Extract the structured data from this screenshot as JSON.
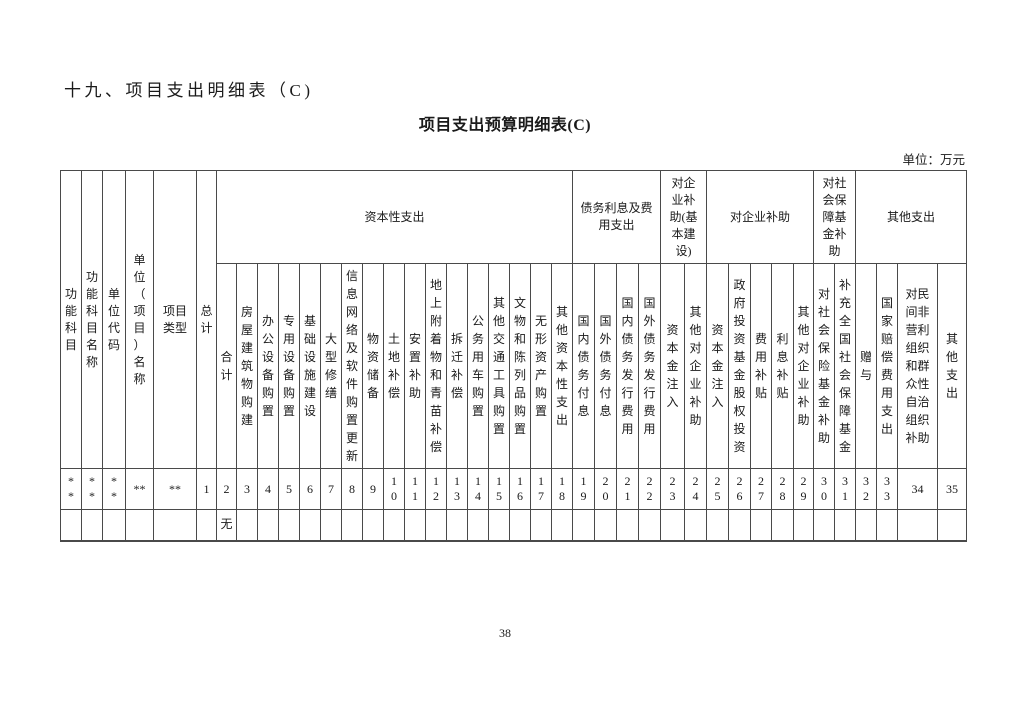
{
  "page": {
    "section_title": "十九、项目支出明细表（C)",
    "table_title": "项目支出预算明细表(C)",
    "unit_label": "单位：万元",
    "page_number": "38"
  },
  "colors": {
    "background": "#ffffff",
    "table_border": "#4a4a4a",
    "text": "#1a1a1a"
  },
  "table": {
    "fixed_columns": [
      {
        "label": "功\n能\n科\n目",
        "width": 21
      },
      {
        "label": "功\n能\n科\n目\n名\n称",
        "width": 21
      },
      {
        "label": "单\n位\n代\n码",
        "width": 23
      },
      {
        "label": "单\n位\n（\n项\n目\n）\n名\n称",
        "width": 28
      },
      {
        "label": "项目\n类型",
        "width": 43
      },
      {
        "label": "总\n计",
        "width": 20
      }
    ],
    "groups": [
      {
        "label": "资本性支出",
        "span": 17
      },
      {
        "label": "债务利息及费\n用支出",
        "span": 4
      },
      {
        "label": "对企\n业补\n助(基\n本建\n设)",
        "span": 2
      },
      {
        "label": "对企业补助",
        "span": 5
      },
      {
        "label": "对社\n会保\n障基\n金补\n助",
        "span": 2
      },
      {
        "label": "其他支出",
        "span": 4
      }
    ],
    "columns": [
      {
        "label": "合\n计",
        "width": 20
      },
      {
        "label": "房\n屋\n建\n筑\n物\n购\n建",
        "width": 21
      },
      {
        "label": "办\n公\n设\n备\n购\n置",
        "width": 21
      },
      {
        "label": "专\n用\n设\n备\n购\n置",
        "width": 21
      },
      {
        "label": "基\n础\n设\n施\n建\n设",
        "width": 21
      },
      {
        "label": "大\n型\n修\n缮",
        "width": 21
      },
      {
        "label": "信\n息\n网\n络\n及\n软\n件\n购\n置\n更\n新",
        "width": 21
      },
      {
        "label": "物\n资\n储\n备",
        "width": 21
      },
      {
        "label": "土\n地\n补\n偿",
        "width": 21
      },
      {
        "label": "安\n置\n补\n助",
        "width": 21
      },
      {
        "label": "地\n上\n附\n着\n物\n和\n青\n苗\n补\n偿",
        "width": 21
      },
      {
        "label": "拆\n迁\n补\n偿",
        "width": 21
      },
      {
        "label": "公\n务\n用\n车\n购\n置",
        "width": 21
      },
      {
        "label": "其\n他\n交\n通\n工\n具\n购\n置",
        "width": 21
      },
      {
        "label": "文\n物\n和\n陈\n列\n品\n购\n置",
        "width": 21
      },
      {
        "label": "无\n形\n资\n产\n购\n置",
        "width": 21
      },
      {
        "label": "其\n他\n资\n本\n性\n支\n出",
        "width": 21
      },
      {
        "label": "国\n内\n债\n务\n付\n息",
        "width": 22
      },
      {
        "label": "国\n外\n债\n务\n付\n息",
        "width": 22
      },
      {
        "label": "国\n内\n债\n务\n发\n行\n费\n用",
        "width": 22
      },
      {
        "label": "国\n外\n债\n务\n发\n行\n费\n用",
        "width": 22
      },
      {
        "label": "资\n本\n金\n注\n入",
        "width": 24
      },
      {
        "label": "其\n他\n对\n企\n业\n补\n助",
        "width": 22
      },
      {
        "label": "资\n本\n金\n注\n入",
        "width": 22
      },
      {
        "label": "政\n府\n投\n资\n基\n金\n股\n权\n投\n资",
        "width": 22
      },
      {
        "label": "费\n用\n补\n贴",
        "width": 21
      },
      {
        "label": "利\n息\n补\n贴",
        "width": 22
      },
      {
        "label": "其\n他\n对\n企\n业\n补\n助",
        "width": 20
      },
      {
        "label": "对\n社\n会\n保\n险\n基\n金\n补\n助",
        "width": 21
      },
      {
        "label": "补\n充\n全\n国\n社\n会\n保\n障\n基\n金",
        "width": 21
      },
      {
        "label": "赠\n与",
        "width": 21
      },
      {
        "label": "国\n家\n赔\n偿\n费\n用\n支\n出",
        "width": 21
      },
      {
        "label": "对民\n间非\n营利\n组织\n和群\n众性\n自治\n组织\n补助",
        "width": 40
      },
      {
        "label": "其\n他\n支\n出",
        "width": 29
      }
    ],
    "rows": [
      {
        "cells": [
          "*\n*",
          "*\n*",
          "*\n*",
          "**",
          "**",
          "1",
          "2",
          "3",
          "4",
          "5",
          "6",
          "7",
          "8",
          "9",
          "1\n0",
          "1\n1",
          "1\n2",
          "1\n3",
          "1\n4",
          "1\n5",
          "1\n6",
          "1\n7",
          "1\n8",
          "1\n9",
          "2\n0",
          "2\n1",
          "2\n2",
          "2\n3",
          "2\n4",
          "2\n5",
          "2\n6",
          "2\n7",
          "2\n8",
          "2\n9",
          "3\n0",
          "3\n1",
          "3\n2",
          "3\n3",
          "34",
          "35"
        ]
      },
      {
        "cells": [
          "",
          "",
          "",
          "",
          "",
          "",
          "无",
          "",
          "",
          "",
          "",
          "",
          "",
          "",
          "",
          "",
          "",
          "",
          "",
          "",
          "",
          "",
          "",
          "",
          "",
          "",
          "",
          "",
          "",
          "",
          "",
          "",
          "",
          "",
          "",
          "",
          "",
          "",
          "",
          ""
        ]
      }
    ]
  }
}
